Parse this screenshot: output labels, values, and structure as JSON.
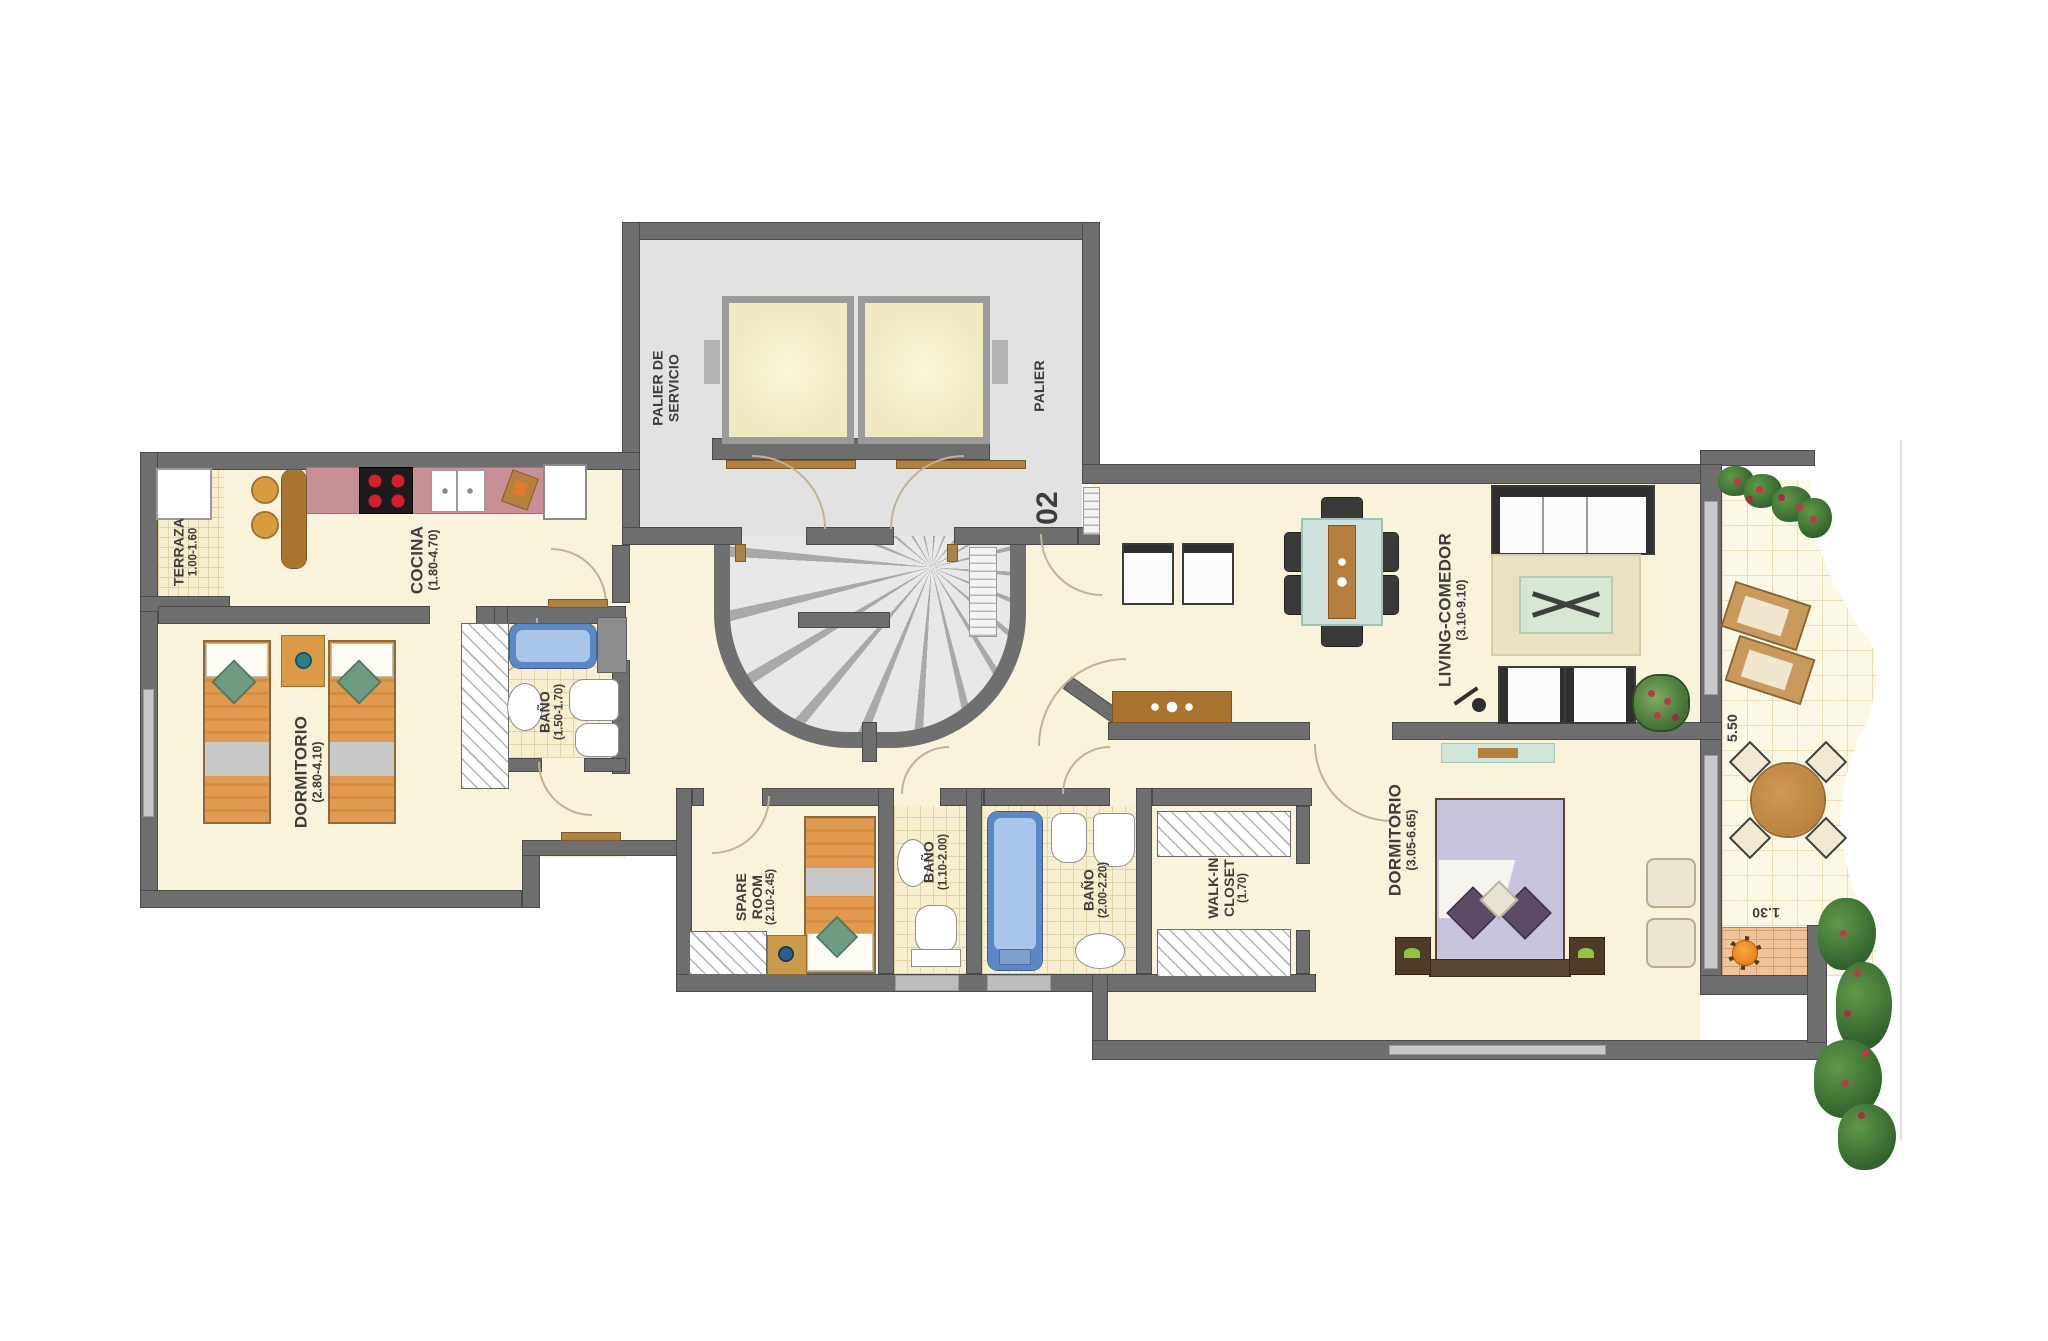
{
  "rooms": {
    "terraza": {
      "name": "TERRAZA",
      "dims": "1.00-1.60"
    },
    "cocina": {
      "name": "COCINA",
      "dims": "(1.80-4.70)"
    },
    "dormitorio1": {
      "name": "DORMITORIO",
      "dims": "(2.80-4.10)"
    },
    "bano1": {
      "name": "BAÑO",
      "dims": "(1.50-1.70)"
    },
    "palier_servicio": {
      "name": "PALIER DE SERVICIO"
    },
    "palier": {
      "name": "PALIER"
    },
    "spare_room": {
      "name": "SPARE ROOM",
      "dims": "(2.10-2.45)"
    },
    "bano2": {
      "name": "BAÑO",
      "dims": "(1.10-2.00)"
    },
    "bano3": {
      "name": "BAÑO",
      "dims": "(2.00-2.20)"
    },
    "walk_in_closet": {
      "name": "WALK-IN CLOSET",
      "dims": "(1.70)"
    },
    "living": {
      "name": "LIVING-COMEDOR",
      "dims": "(3.10-9.10)"
    },
    "dormitorio2": {
      "name": "DORMITORIO",
      "dims": "(3.05-6.65)"
    }
  },
  "annotations": {
    "unit_number": "02",
    "terrace_depth": "5.50",
    "bbq_width": "1.30"
  }
}
